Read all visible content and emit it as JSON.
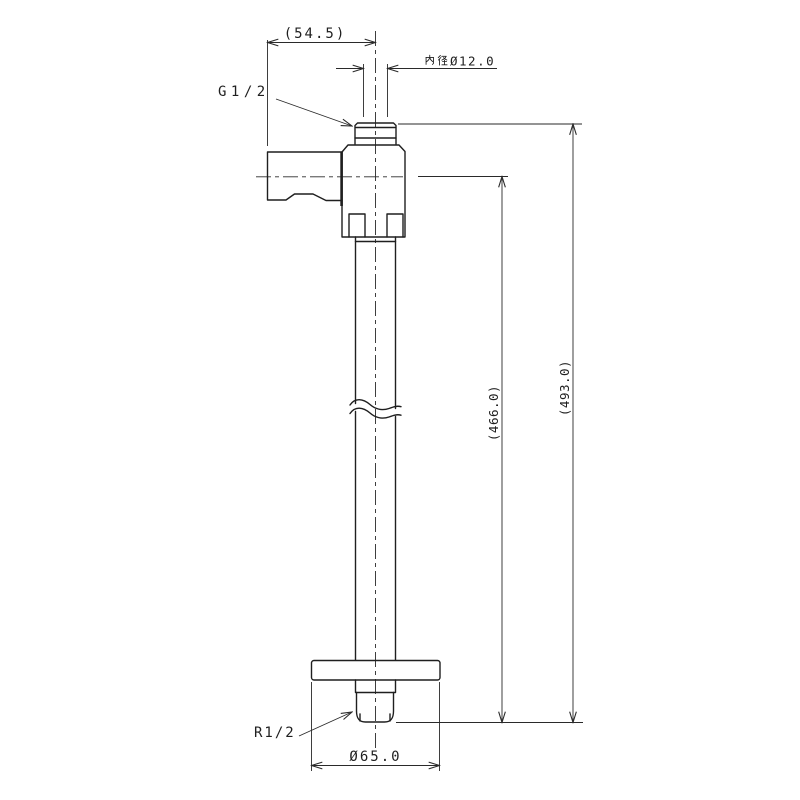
{
  "drawing": {
    "type": "technical-drawing",
    "subject": "wall-mounted stop valve with standpipe, flange and threaded ends",
    "colors": {
      "background": "#ffffff",
      "line": "#1f1f1f"
    }
  },
  "labels": {
    "dim_width_top": "(54.5)",
    "dim_inner_diameter_full": "内径Ø12.0",
    "dim_inner_diameter_kanji": "内径",
    "dim_inner_diameter_value": "Ø12.0",
    "thread_top": "G1/2",
    "dim_height_to_tip_from_inlet": "(466.0)",
    "dim_overall_height": "(493.0)",
    "thread_bottom": "R1/2",
    "dim_flange_diameter": "Ø65.0"
  }
}
